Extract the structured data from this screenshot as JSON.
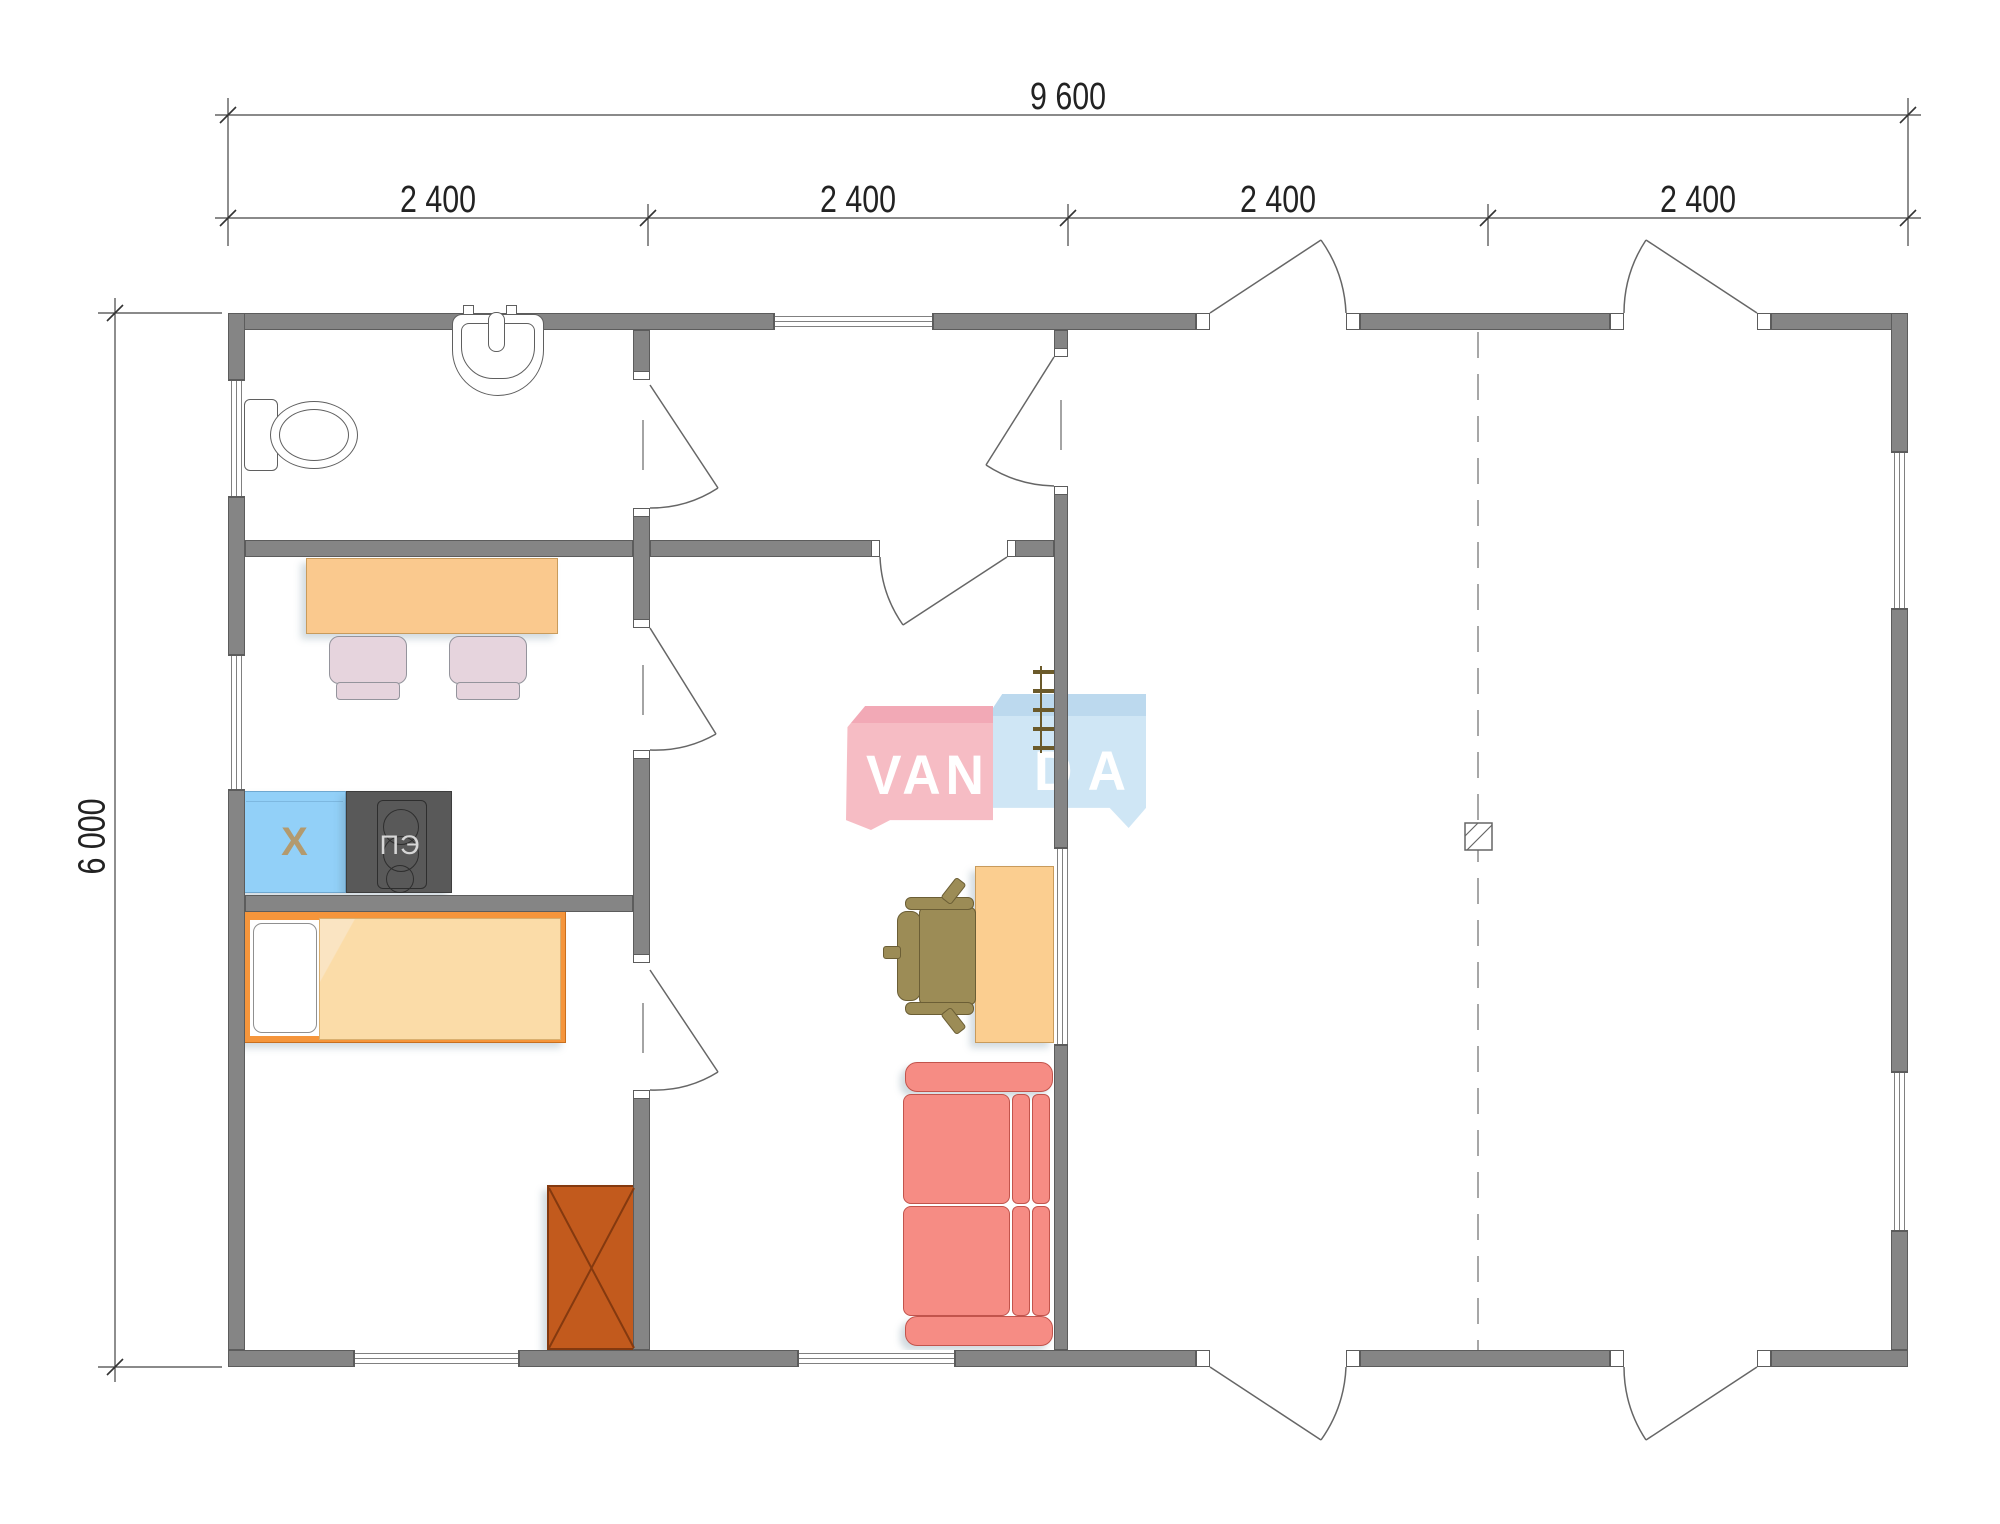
{
  "drawing": {
    "type": "house floor plan",
    "watermark": "VANDA"
  },
  "dimensions": {
    "top_total": "9 600",
    "top_segments": [
      "2 400",
      "2 400",
      "2 400",
      "2 400"
    ],
    "left_total": "6 000"
  },
  "appliance_labels": {
    "fridge": "Х",
    "stove": "ПЭ"
  },
  "logo": {
    "left_text": "VAN",
    "right_text": "DA"
  },
  "colors": {
    "wall": "#858585",
    "wall-edge": "#5c5c5c",
    "frame": "#808080",
    "line": "#666666",
    "fixture-line": "#5f5f5f",
    "table": "#FAC98E",
    "table-edge": "#C89B5C",
    "chair": "#E6D4DD",
    "chair-edge": "#94949C",
    "fridge": "#92D0F8",
    "fridge-edge": "#6FA8D0",
    "fridge-label": "#B39A6E",
    "stove": "#595959",
    "stove-edge": "#3D3D3D",
    "stove-detail": "#2E2E2E",
    "stove-label": "#D6D6D6",
    "bed-frame": "#F5953B",
    "bed-frame-edge": "#C96F1E",
    "blanket": "#FBDCA8",
    "pillow": "#FFFFFF",
    "wardrobe": "#C25A1D",
    "wardrobe-edge": "#84390F",
    "sofa": "#F68C84",
    "sofa-edge": "#C2544C",
    "desk": "#FBCE90",
    "desk-edge": "#C89B5C",
    "office-chair": "#9C8C56",
    "office-chair-edge": "#6B5E35",
    "ladder": "#6B5A2A",
    "logo-pink": "#F6BCC4",
    "logo-pink-top": "#F2A9B6",
    "logo-blue": "#CFE6F5",
    "logo-blue-top": "#BCD9EE",
    "logo-text": "#FFFFFF"
  }
}
